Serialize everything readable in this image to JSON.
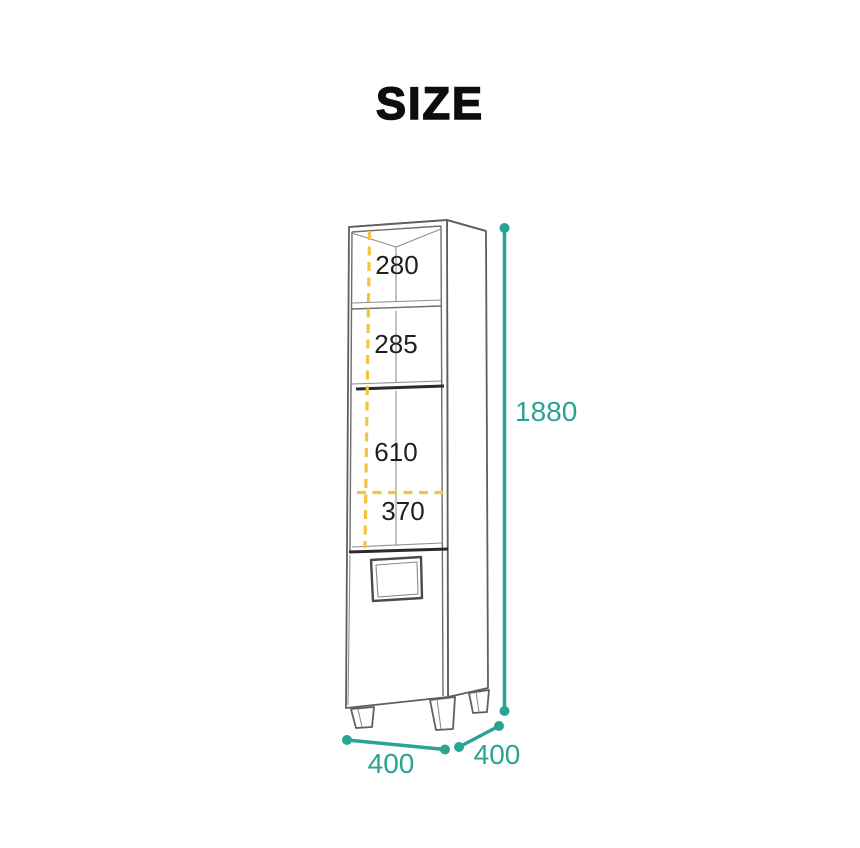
{
  "title": "SIZE",
  "interior": {
    "top_shelf_height": "280",
    "middle_shelf_height": "285",
    "lower_compartment_height": "610",
    "interior_width": "370"
  },
  "overall": {
    "height": "1880",
    "width": "400",
    "depth": "400"
  },
  "colors": {
    "dimension_teal": "#2AA392",
    "guide_yellow": "#F7C23E",
    "drawing_line_gray": "#5f5f5f",
    "label_black": "#1f1f1f"
  }
}
